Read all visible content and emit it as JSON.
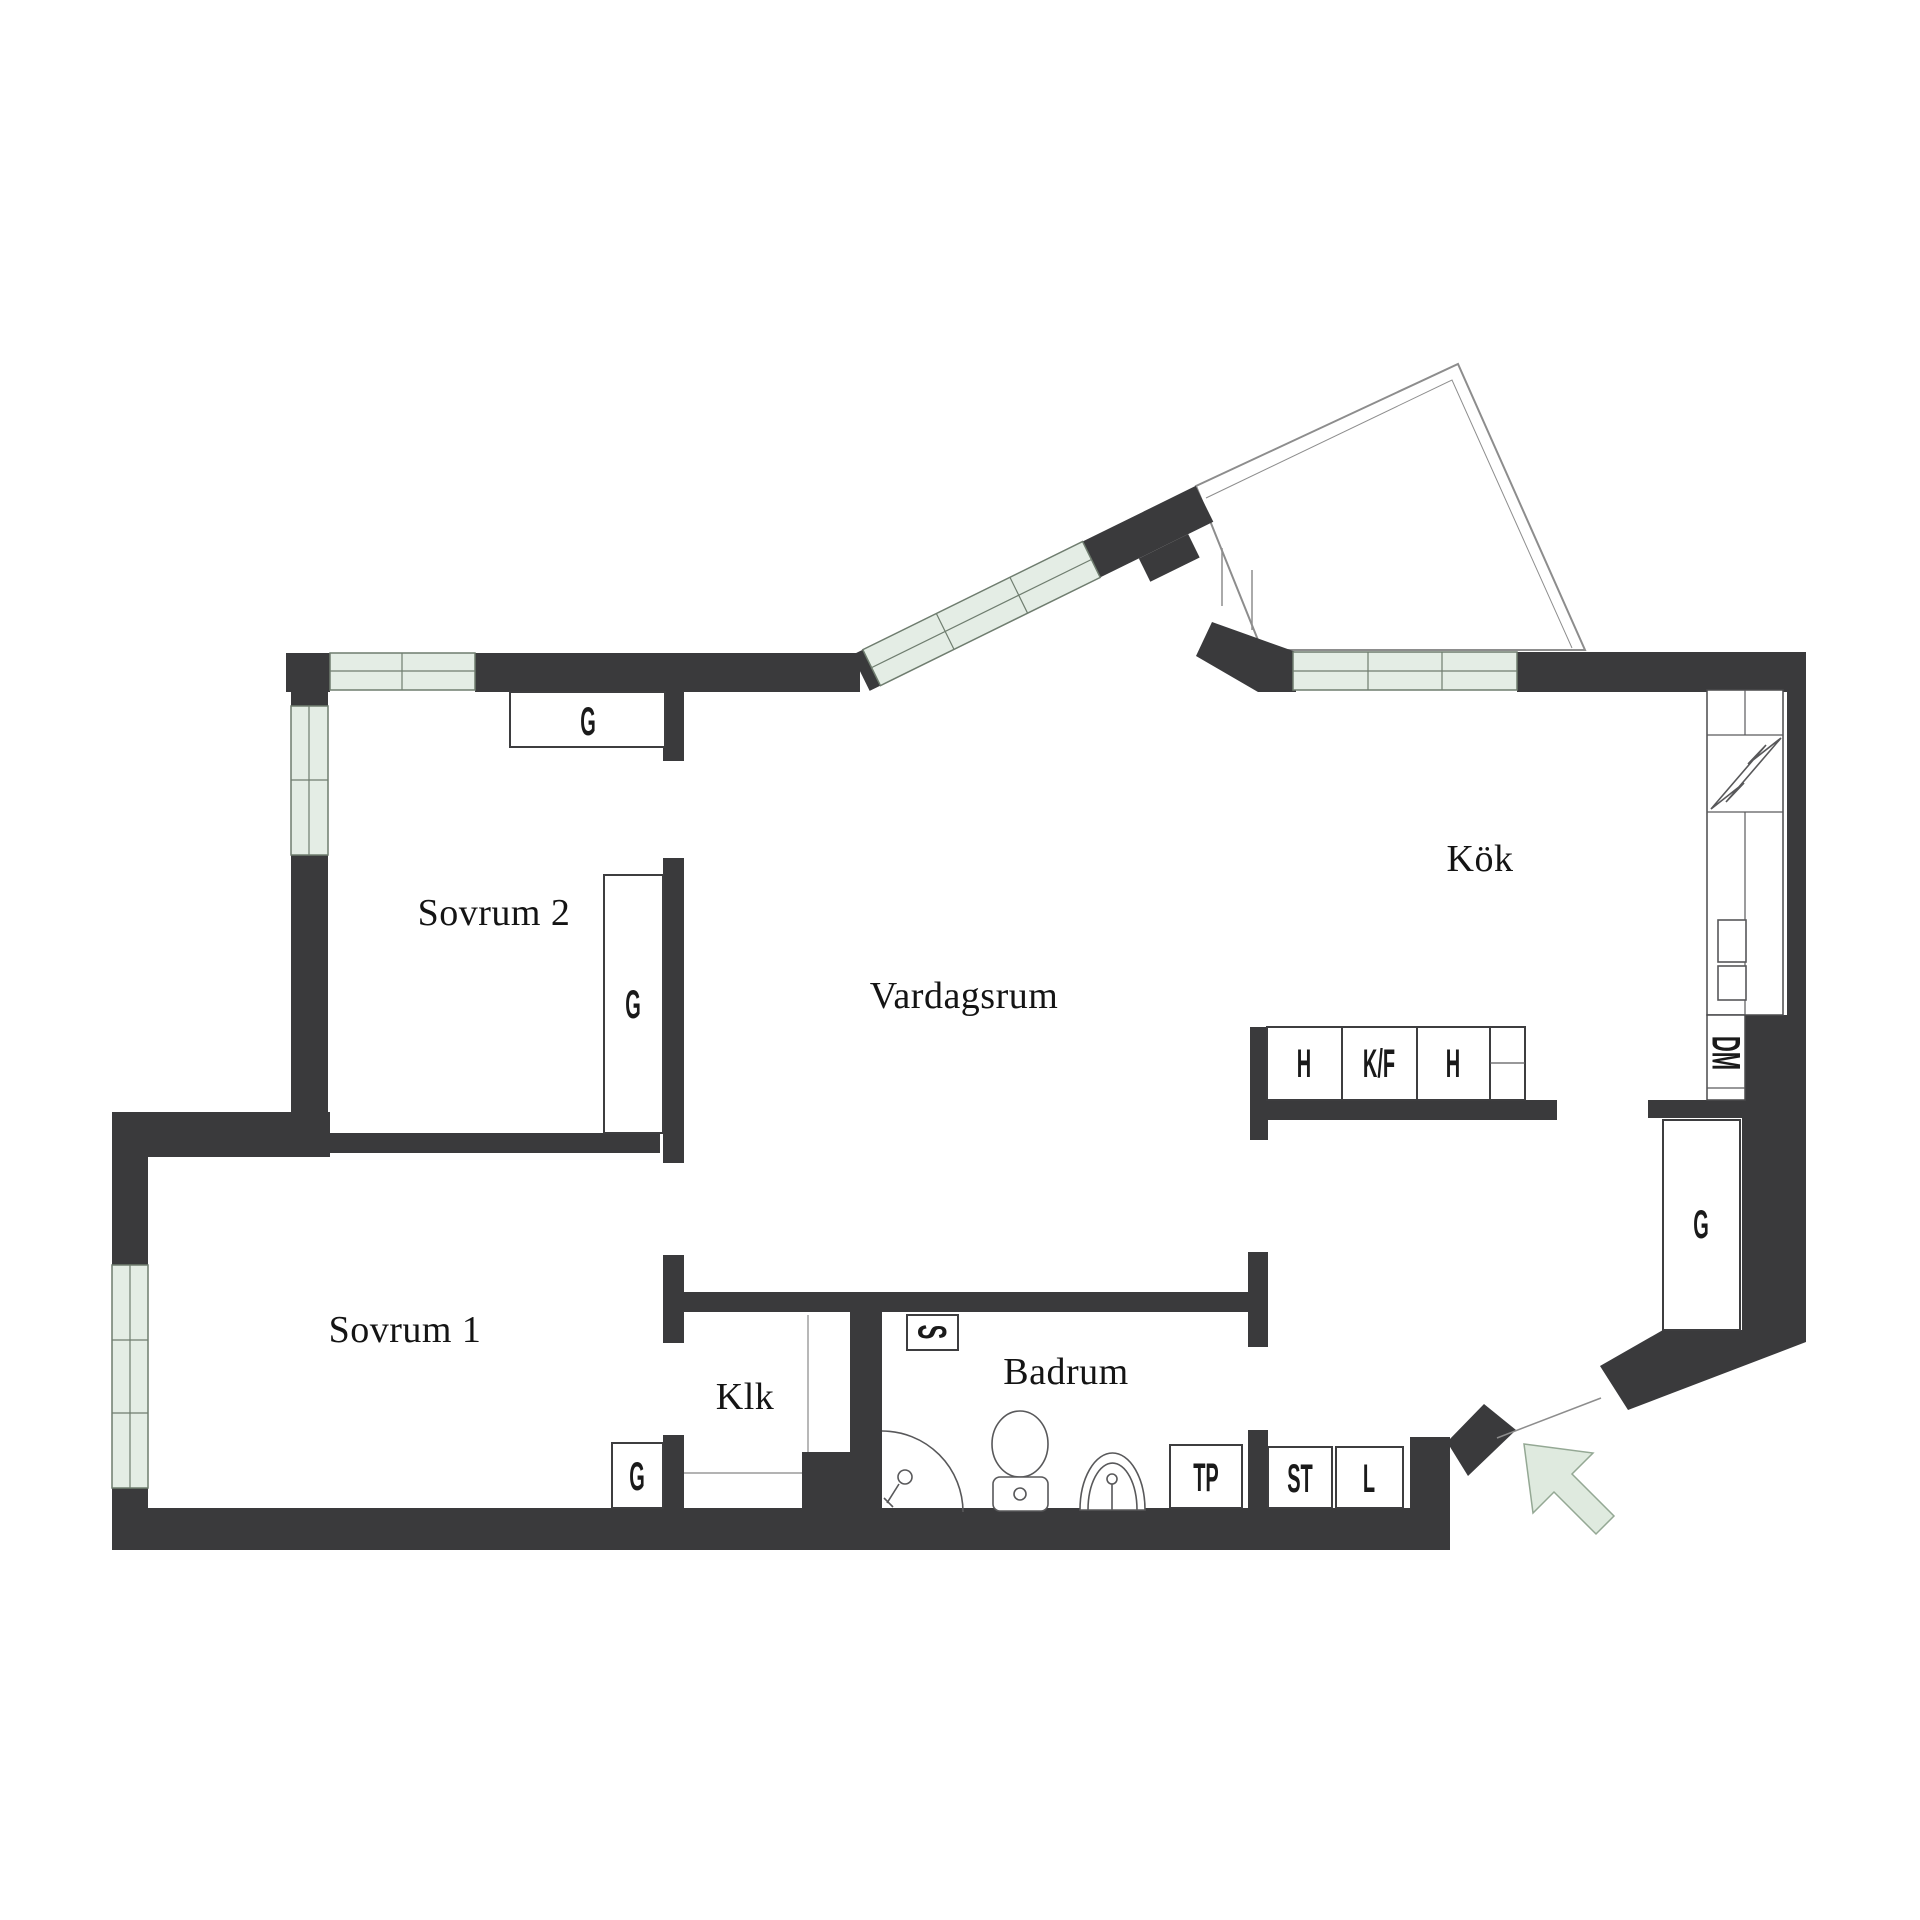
{
  "rooms": {
    "sovrum_2": "Sovrum 2",
    "vardagsrum": "Vardagsrum",
    "kok": "Kök",
    "sovrum_1": "Sovrum 1",
    "klk": "Klk",
    "badrum": "Badrum"
  },
  "closets": {
    "g_top": "G",
    "g_sovrum2": "G",
    "g_klk": "G",
    "g_hall": "G"
  },
  "kitchen": {
    "cab_h_left": "H",
    "cab_kf": "K/F",
    "cab_h_right": "H",
    "dishwasher": "DM"
  },
  "utility": {
    "shaft": "S",
    "washer_tower": "TP",
    "cleaning": "ST",
    "linen": "L"
  },
  "icons": {
    "stove": "lightning-bolt-icon",
    "entrance": "entrance-arrow-icon",
    "toilet": "toilet-icon",
    "sink": "sink-icon",
    "shower": "shower-icon"
  },
  "colors": {
    "wall": "#3a3a3c",
    "window_fill": "#e4ede5",
    "window_stroke": "#6f7d6f",
    "arrow_fill": "#dfeadf",
    "arrow_stroke": "#94a894",
    "fixture_stroke": "#58585a",
    "text": "#141414"
  }
}
